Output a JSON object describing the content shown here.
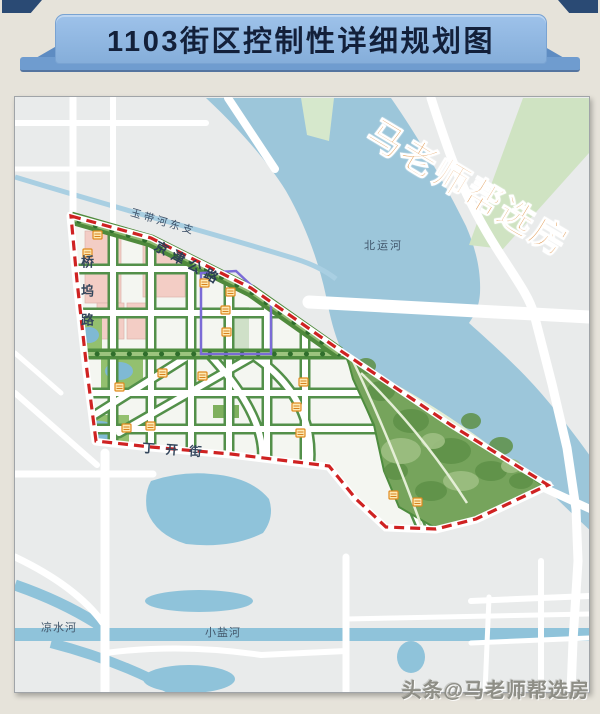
{
  "banner": {
    "title": "1103街区控制性详细规划图"
  },
  "map": {
    "labels": {
      "north_canal": "北运河",
      "yudai_river": "玉带河东支",
      "jingjin_highway": "京津公路",
      "west_road": "桥坞路",
      "dingkai_street": "丁开街",
      "liangshui_river": "凉水河",
      "xiaoyan_river": "小盐河"
    },
    "watermarks": {
      "diagonal": "马老师帮选房",
      "byline": "头条@马老师帮选房"
    },
    "colors": {
      "water": "#9cc6da",
      "park_dark": "#76a45c",
      "park_light": "#cfe3c2",
      "road_green": "#53904a",
      "boundary_red": "#cf2222",
      "sub_boundary_purple": "#7a6bd6",
      "residential_pink": "#f3cdc5",
      "marker_orange": "#e08a1e",
      "banner_blue": "#8fb5e0",
      "watermark_orange": "#d9822b"
    },
    "markers": [
      [
        92,
        230
      ],
      [
        82,
        248
      ],
      [
        199,
        278
      ],
      [
        225,
        287
      ],
      [
        220,
        305
      ],
      [
        221,
        327
      ],
      [
        157,
        368
      ],
      [
        197,
        371
      ],
      [
        114,
        382
      ],
      [
        121,
        423
      ],
      [
        145,
        421
      ],
      [
        291,
        402
      ],
      [
        295,
        428
      ],
      [
        298,
        377
      ],
      [
        388,
        490
      ],
      [
        412,
        497
      ]
    ]
  }
}
